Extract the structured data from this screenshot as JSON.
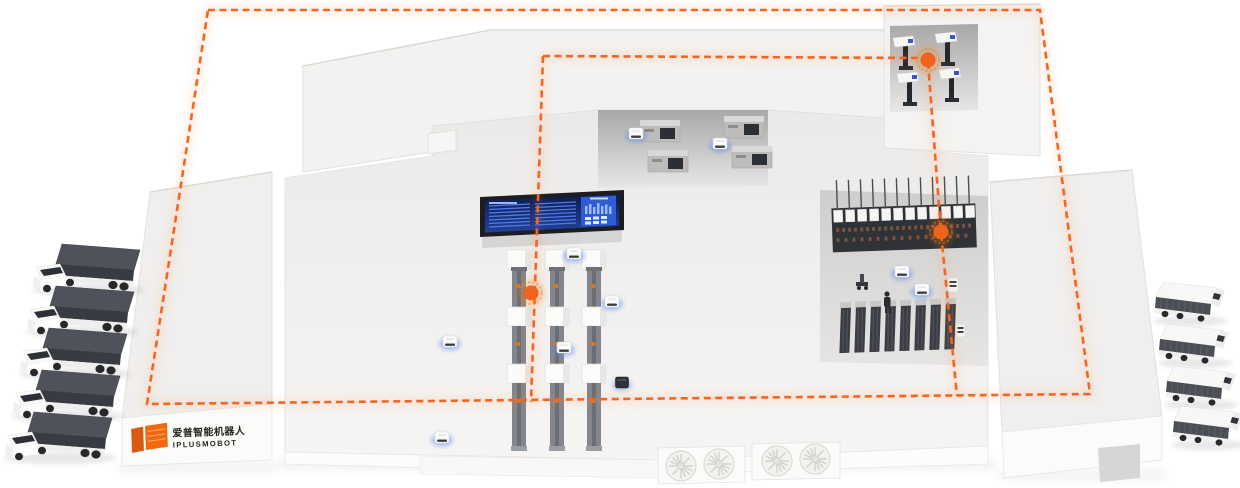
{
  "scene": {
    "name": "smart-factory-intralogistics-isometric-illustration",
    "background_color": "#ffffff",
    "building_roof_color": "#f1f0ee",
    "building_front_color": "#fbfbfa",
    "courtyard_shadow_color": "#b0afad"
  },
  "brand": {
    "name_cn": "爱普智能机器人",
    "name_en": "IPLUSMOBOT",
    "mark_color": "#f2680f",
    "mark_shape": "orange-split-flag-mark"
  },
  "routes": {
    "color": "#f3661f",
    "style": "dashed",
    "outer_loop": [
      [
        208,
        10
      ],
      [
        1040,
        10
      ],
      [
        1090,
        394
      ],
      [
        147,
        404
      ]
    ],
    "branch_top_horizontal": [
      [
        543,
        56
      ],
      [
        924,
        58
      ]
    ],
    "branch_right_vertical": [
      [
        928,
        62
      ],
      [
        941,
        232
      ],
      [
        957,
        396
      ]
    ],
    "branch_center_vertical": [
      [
        543,
        56
      ],
      [
        531,
        402
      ]
    ]
  },
  "waypoints": {
    "dot_color": "#f0631c",
    "glow_color": "rgba(244,114,27,0.2)",
    "points": [
      {
        "id": "station-center-line",
        "x": 531,
        "y": 293
      },
      {
        "id": "station-machine-row",
        "x": 941,
        "y": 232
      },
      {
        "id": "station-top-cell",
        "x": 928,
        "y": 60
      }
    ]
  },
  "fleet": {
    "trucks_left": {
      "count": 5,
      "type": "cargo-truck",
      "box_color": "#4f525a"
    },
    "trucks_right": {
      "count": 4,
      "type": "box-truck",
      "side_color": "#4b4e54"
    },
    "agv_robots_white": {
      "count": 9,
      "glow_color": "#5b8df5"
    },
    "agv_robots_dark": {
      "count": 1
    },
    "forklift_robots": {
      "count": 2
    },
    "workers": {
      "count": 1
    }
  },
  "factory": {
    "production_lines": {
      "count": 3,
      "machine_boxes_per_line": 3,
      "conveyor_segments_per_line": 4
    },
    "machine_cells_top_right": {
      "count": 4
    },
    "machine_cells_top_middle": {
      "count": 4
    },
    "long_machine_row": {
      "segments": 12
    },
    "rack_units": {
      "count": 8
    },
    "fan_blocks": {
      "count": 2,
      "fans_per_block": 2
    }
  },
  "dashboard": {
    "type": "production-monitor-big-screen",
    "frame_color": "#1b1d21",
    "screen_color": "#101d4e",
    "panel_color": "#2e5cd4",
    "row_color": "#4f7ce8"
  }
}
